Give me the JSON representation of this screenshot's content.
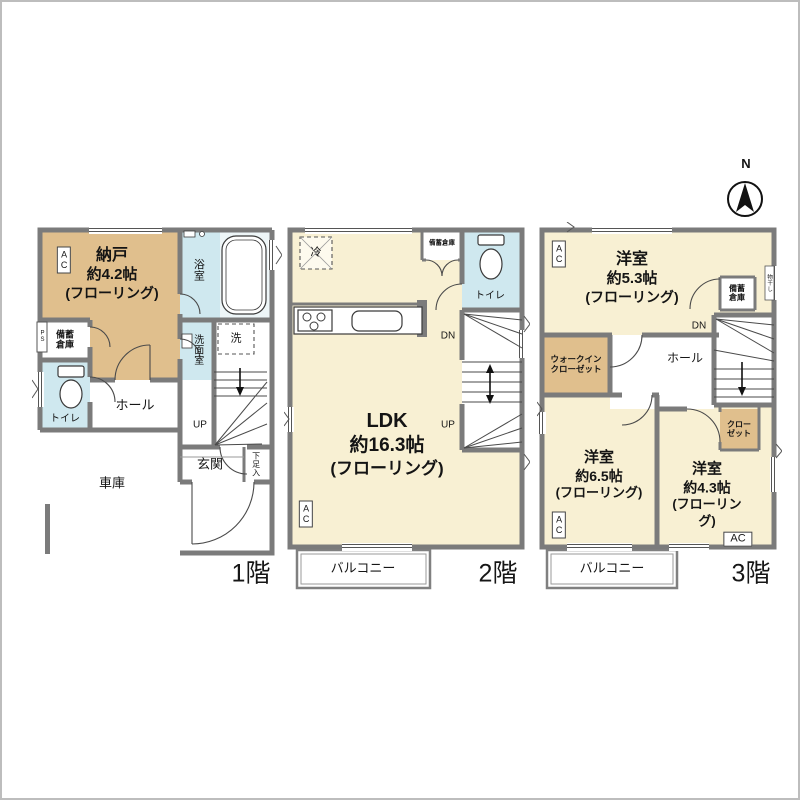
{
  "compass": {
    "north_label": "N"
  },
  "colors": {
    "flooring_cream": "#f8f0d3",
    "storage_tan": "#e0bf8d",
    "wet_area_blue": "#cfe8ef",
    "wall_gray": "#7b7b7b"
  },
  "floor1": {
    "floor_label": "1階",
    "ac_label": "AC",
    "nando": {
      "name": "納戸",
      "size": "約4.2帖",
      "note": "(フローリング)"
    },
    "bath": "浴室",
    "washer": "洗",
    "washroom": "洗面室",
    "storage": "備蓄倉庫",
    "ps": "PS",
    "toilet": "トイレ",
    "hall": "ホール",
    "up": "UP",
    "genkan": "玄関",
    "shoe_box": "下足入",
    "garage": "車庫"
  },
  "floor2": {
    "floor_label": "2階",
    "fridge": "冷",
    "storage": "備蓄倉庫",
    "toilet": "トイレ",
    "dn": "DN",
    "up": "UP",
    "ldk": {
      "name": "LDK",
      "size": "約16.3帖",
      "note": "(フローリング)"
    },
    "ac_label": "AC",
    "balcony": "バルコニー"
  },
  "floor3": {
    "floor_label": "3階",
    "ac_label": "AC",
    "room_53": {
      "name": "洋室",
      "size": "約5.3帖",
      "note": "(フローリング)"
    },
    "storage": "備蓄倉庫",
    "laundry": "物干し",
    "dn": "DN",
    "hall": "ホール",
    "wic": "ウォークインクローゼット",
    "closet": "クローゼット",
    "room_65": {
      "name": "洋室",
      "size": "約6.5帖",
      "note": "(フローリング)"
    },
    "room_43": {
      "name": "洋室",
      "size": "約4.3帖",
      "note": "(フローリング)"
    },
    "balcony": "バルコニー"
  }
}
